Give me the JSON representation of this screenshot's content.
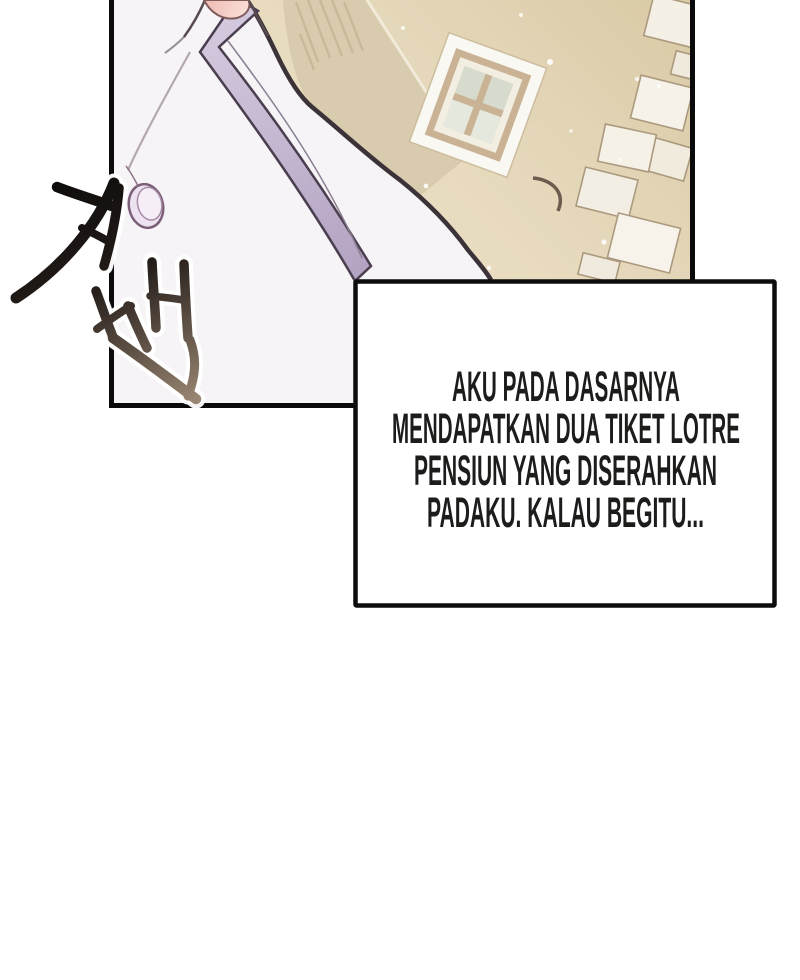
{
  "page": {
    "width": 800,
    "height": 980,
    "background": "#ffffff",
    "kind": "webtoon strip segment"
  },
  "panel": {
    "border_color": "#0a0a0a",
    "scene_objects": [
      "white coat shoulder with lavender trim",
      "round coat button",
      "pink neckline skin",
      "beige wall",
      "four-pane window",
      "corner stone blocks",
      "shaded building corner",
      "sparkle dots"
    ],
    "colors": {
      "wall_light": "#ecdfc2",
      "wall_dark": "#dccdab",
      "corner_face": "#d9cbae",
      "window_frame": "#faf8f2",
      "window_trim": "#c9b394",
      "window_inner": "#f3eee2",
      "window_pane": "#dcdfd2",
      "block_fill": "#f3eee3",
      "block_stroke": "#ab9a7e",
      "coat": "#f6f4f6",
      "coat_outline": "#3c3339",
      "stripe": "#c6bad3",
      "stripe_outline": "#4a3e4f",
      "button_fill": "#ece2f0",
      "button_outline": "#7c5f78",
      "skin": "#f2c8c1"
    }
  },
  "sfx": {
    "text": "저벅",
    "script": "Korean brush calligraphy",
    "ink_dark": "#131010",
    "ink_light": "#9b8773"
  },
  "dialogue_box": {
    "fill": "#ffffff",
    "border_color": "#0d0d0d",
    "text_color": "#1d1c1b",
    "lines": [
      "AKU PADA DASARNYA",
      "MENDAPATKAN DUA TIKET LOTRE",
      "PENSIUN YANG DISERAHKAN",
      "PADAKU. KALAU BEGITU..."
    ],
    "full_text": "AKU PADA DASARNYA MENDAPATKAN DUA TIKET LOTRE PENSIUN YANG DISERAHKAN PADAKU. KALAU BEGITU..."
  }
}
